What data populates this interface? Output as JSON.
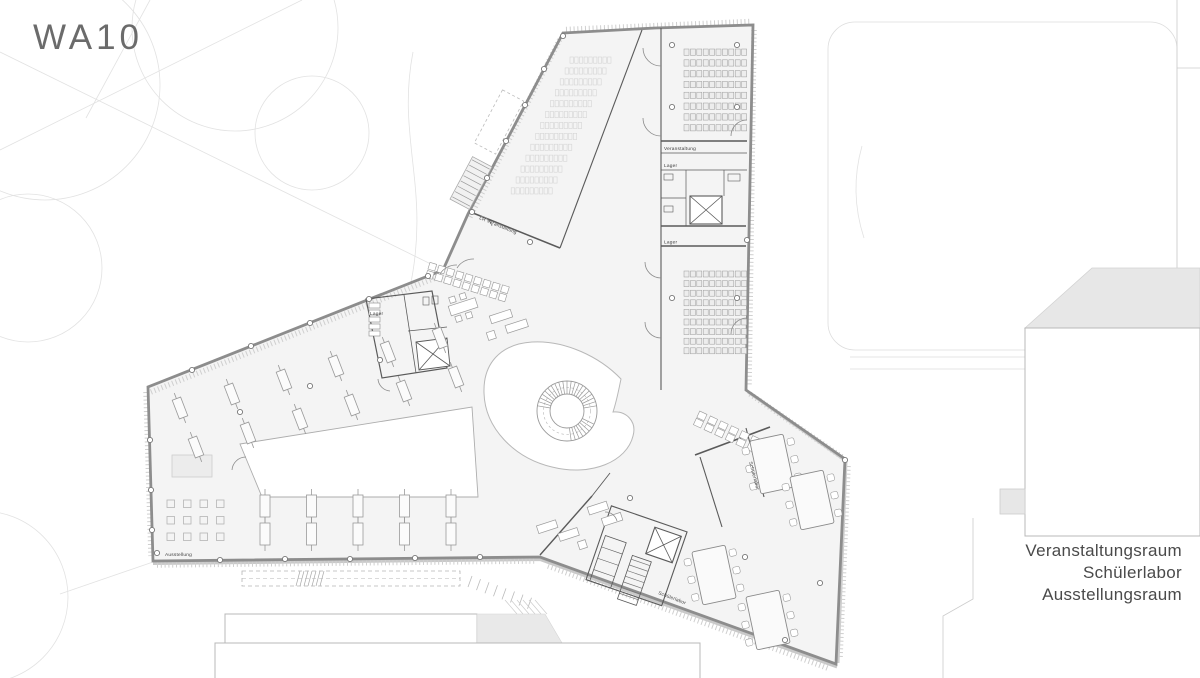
{
  "title": "WA10",
  "legend": {
    "lines": [
      "Veranstaltungsraum",
      "Schülerlabor",
      "Ausstellungsraum"
    ]
  },
  "plan_labels": {
    "veranstaltung": "Veranstaltung",
    "lager_top": "Lager",
    "lager_mid": "Lager",
    "lager_core": "Lager",
    "lr_veranstaltung": "LR Veranstaltung",
    "ausstellung": "Ausstellung",
    "schuelerlabor_a": "Schülerlabor",
    "schuelerlabor_b": "Schülerlabor"
  },
  "colors": {
    "outer_wall": "#8d8d8d",
    "interior_fill": "#f4f4f4",
    "interior_wall": "#5a5a5a",
    "context_fill": "#e7e7e7",
    "faint_site": "#e2e2e2",
    "label_text": "#3d3d3d",
    "title_text": "#6b6b6b",
    "legend_text": "#4a4a4a"
  }
}
